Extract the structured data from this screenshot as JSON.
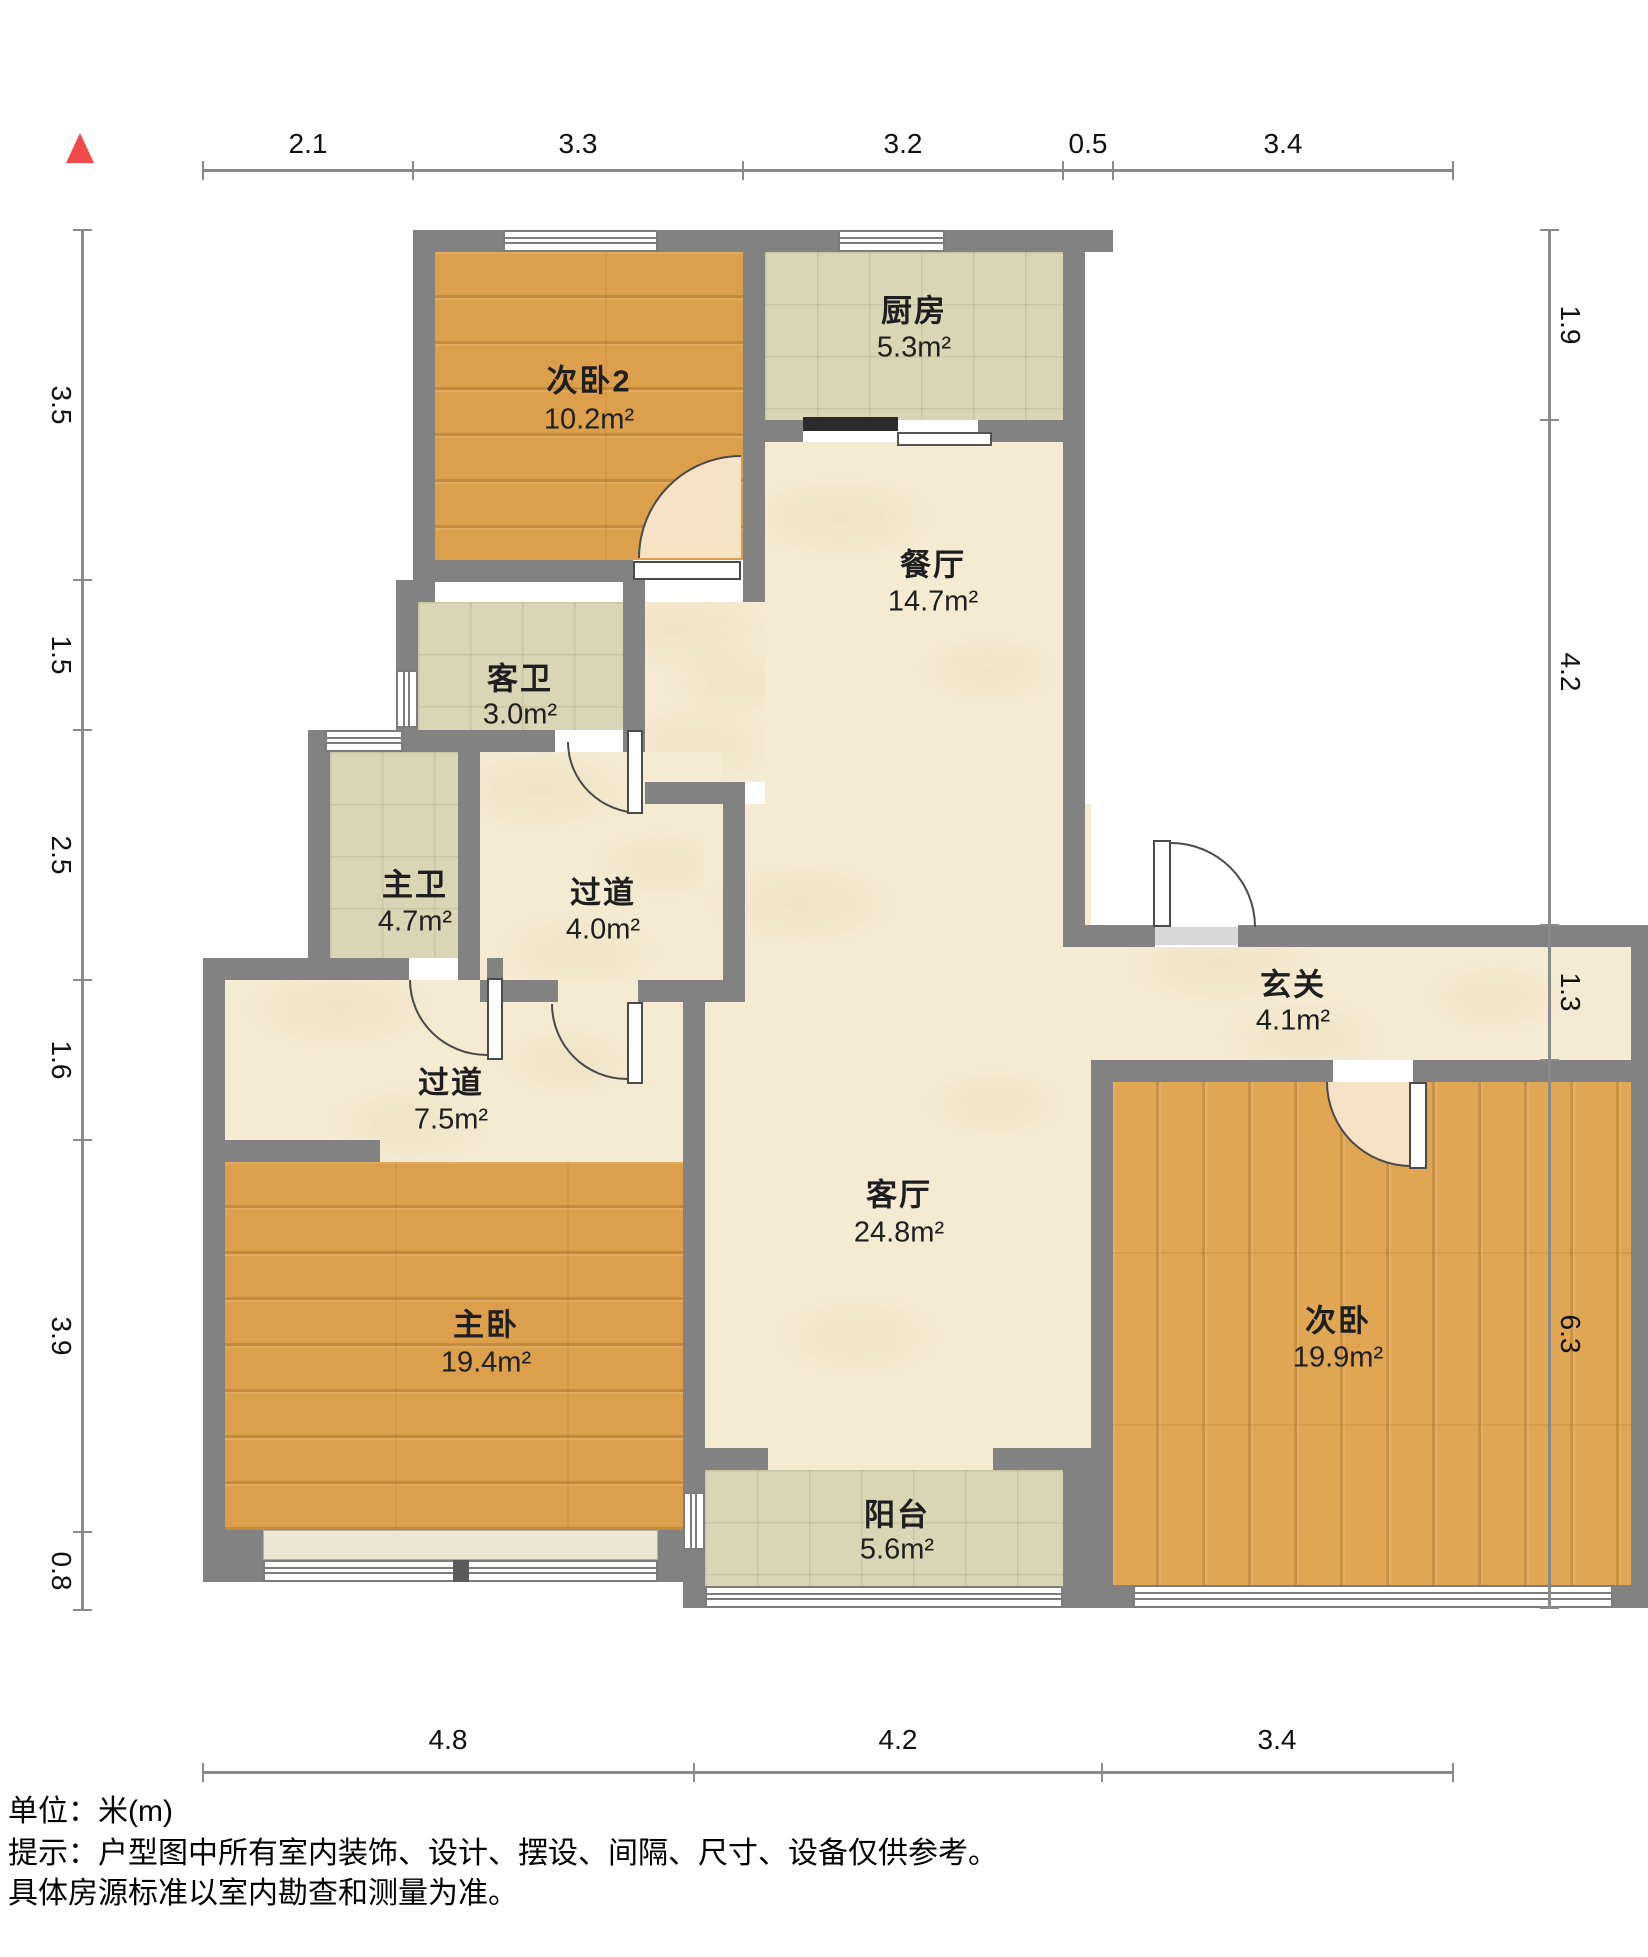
{
  "plan_type": "residential-floor-plan",
  "north_marker": {
    "shape": "triangle",
    "color": "#f2494c"
  },
  "rooms": {
    "bedroom2": {
      "name": "次卧2",
      "area": "10.2m²",
      "floor": "wood"
    },
    "kitchen": {
      "name": "厨房",
      "area": "5.3m²",
      "floor": "tile"
    },
    "dining": {
      "name": "餐厅",
      "area": "14.7m²",
      "floor": "marble"
    },
    "guest_bath": {
      "name": "客卫",
      "area": "3.0m²",
      "floor": "tile"
    },
    "master_bath": {
      "name": "主卫",
      "area": "4.7m²",
      "floor": "tile"
    },
    "hallway_small": {
      "name": "过道",
      "area": "4.0m²",
      "floor": "marble"
    },
    "hallway_large": {
      "name": "过道",
      "area": "7.5m²",
      "floor": "marble"
    },
    "entry": {
      "name": "玄关",
      "area": "4.1m²",
      "floor": "marble"
    },
    "living": {
      "name": "客厅",
      "area": "24.8m²",
      "floor": "marble"
    },
    "master_bedroom": {
      "name": "主卧",
      "area": "19.4m²",
      "floor": "wood"
    },
    "bedroom": {
      "name": "次卧",
      "area": "19.9m²",
      "floor": "wood"
    },
    "balcony": {
      "name": "阳台",
      "area": "5.6m²",
      "floor": "tile"
    }
  },
  "dimensions": {
    "top": [
      "2.1",
      "3.3",
      "3.2",
      "0.5",
      "3.4"
    ],
    "left": [
      "3.5",
      "1.5",
      "2.5",
      "1.6",
      "3.9",
      "0.8"
    ],
    "right": [
      "1.9",
      "4.2",
      "1.3",
      "6.3"
    ],
    "bottom": [
      "4.8",
      "4.2",
      "3.4"
    ]
  },
  "footer": {
    "unit_line": "单位：米(m)",
    "tip_line": "提示：户型图中所有室内装饰、设计、摆设、间隔、尺寸、设备仅供参考。",
    "note_line": "具体房源标准以室内勘查和测量为准。"
  },
  "colors": {
    "wall": "#828282",
    "wood_floor": "#dca04d",
    "tile_floor": "#d9d6b6",
    "marble_floor": "#f5ebd3",
    "north_marker": "#f2494c",
    "dimension_line": "#8a8a8a"
  }
}
